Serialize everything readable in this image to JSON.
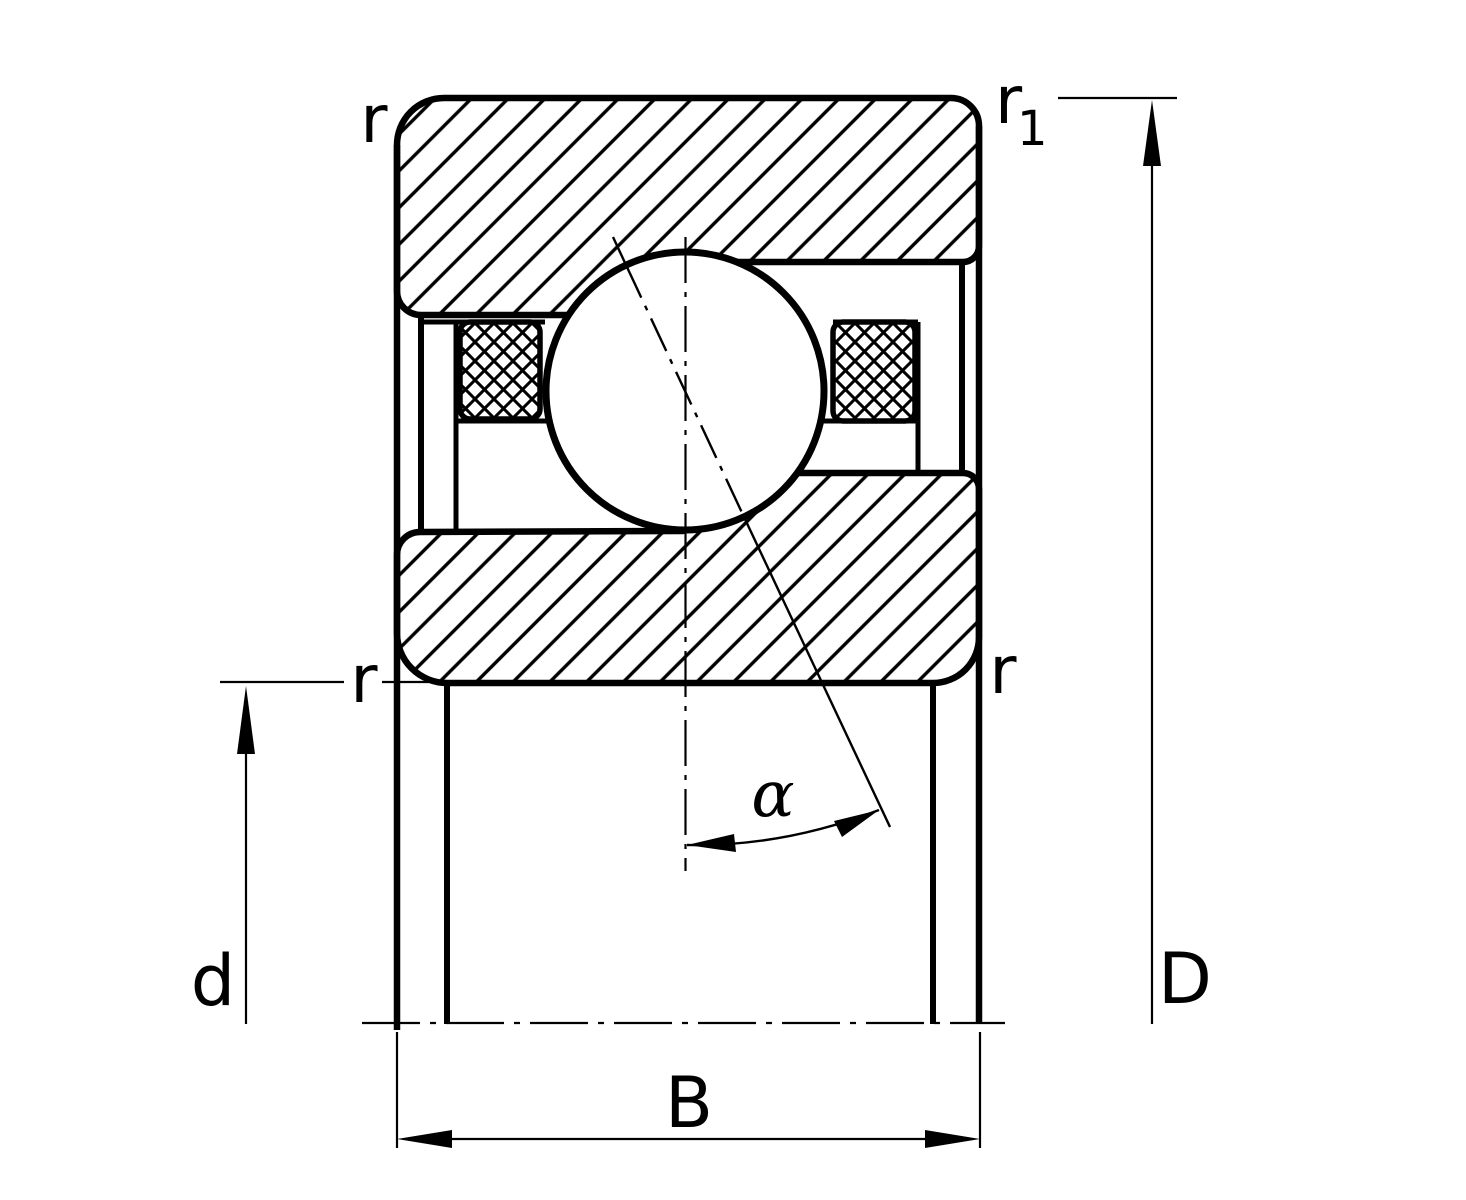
{
  "colors": {
    "ink": "#000000",
    "background": "#ffffff"
  },
  "drawing": {
    "labels": {
      "chamfer_top_left": "r",
      "chamfer_top_right_base": "r",
      "chamfer_top_right_sub": "1",
      "chamfer_mid_left": "r",
      "chamfer_mid_right": "r",
      "bore_diameter": "d",
      "outside_diameter": "D",
      "width": "B",
      "contact_angle": "α"
    }
  }
}
